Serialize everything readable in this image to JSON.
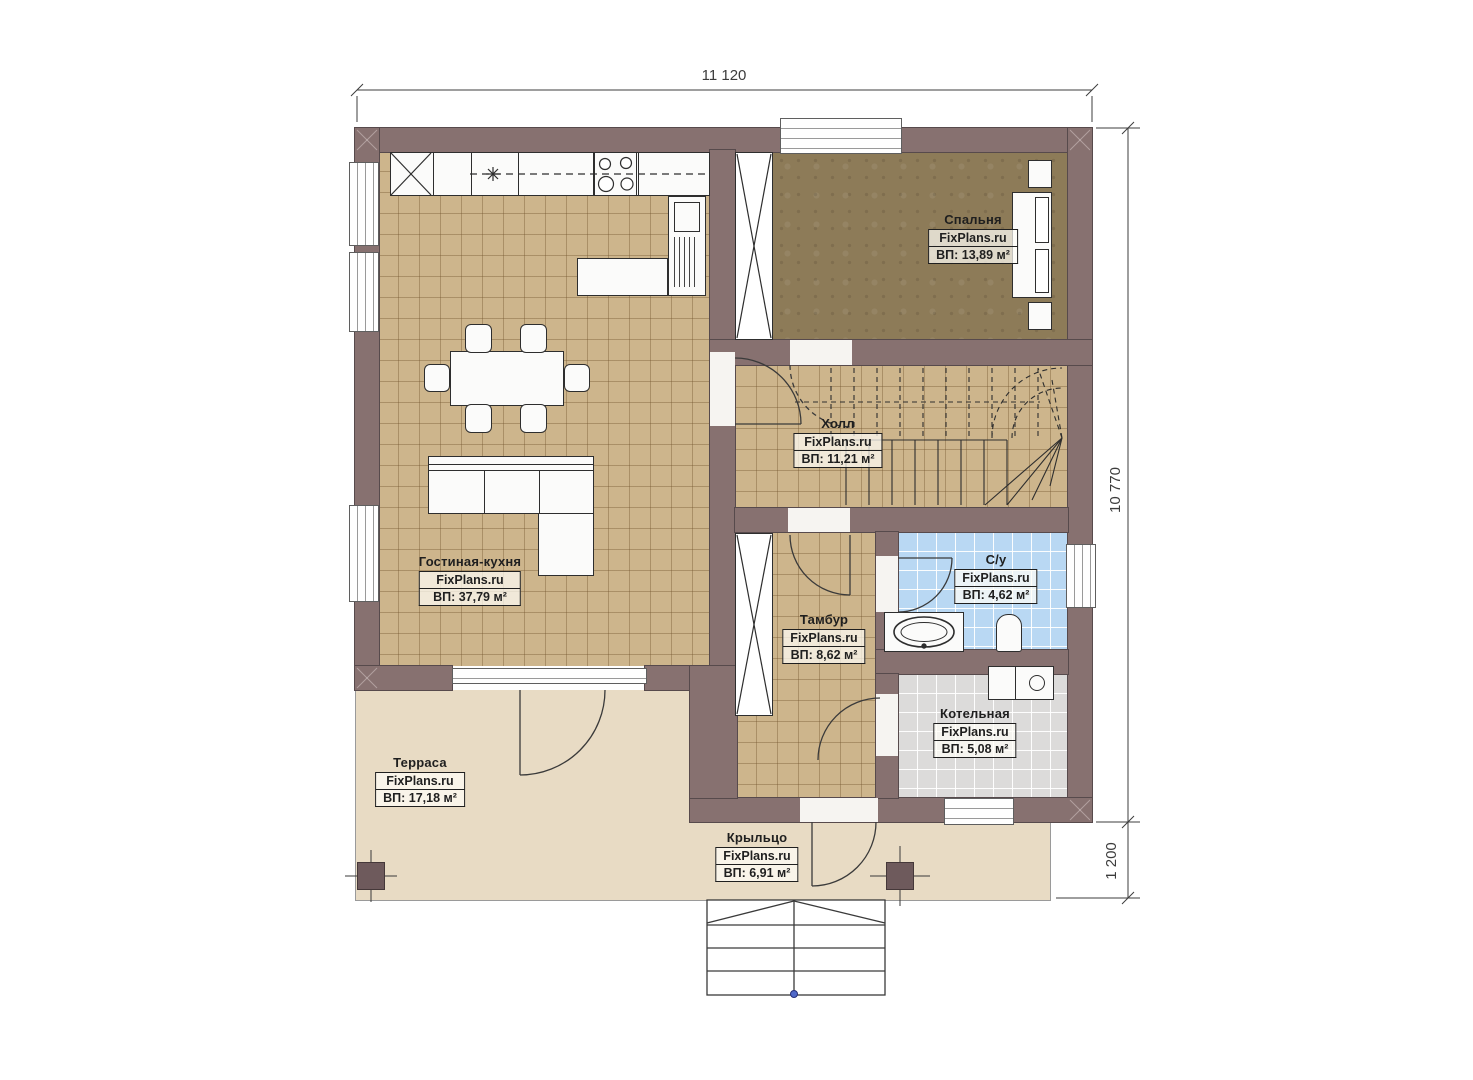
{
  "plan": {
    "watermark": "FixPlans.ru",
    "dimensions": {
      "top": "11 120",
      "right": "10 770",
      "right_lower": "1 200"
    },
    "rooms": {
      "living": {
        "name": "Гостиная-кухня",
        "area": "ВП: 37,79 м²"
      },
      "bedroom": {
        "name": "Спальня",
        "area": "ВП: 13,89 м²"
      },
      "hall": {
        "name": "Холл",
        "area": "ВП: 11,21 м²"
      },
      "bathroom": {
        "name": "С/у",
        "area": "ВП: 4,62 м²"
      },
      "vestibule": {
        "name": "Тамбур",
        "area": "ВП: 8,62 м²"
      },
      "boiler": {
        "name": "Котельная",
        "area": "ВП: 5,08 м²"
      },
      "terrace": {
        "name": "Терраса",
        "area": "ВП: 17,18 м²"
      },
      "porch": {
        "name": "Крыльцо",
        "area": "ВП: 6,91 м²"
      }
    },
    "colors": {
      "wall": "#877170",
      "floor_tile": "#cdb58c",
      "floor_bedroom": "#8d7b58",
      "floor_bathroom": "#b9d8f3",
      "floor_boiler": "#dcdbda",
      "floor_terrace": "#e8dbc4",
      "lines": "#3a3a3a",
      "entry_dot": "#5069c9"
    }
  }
}
